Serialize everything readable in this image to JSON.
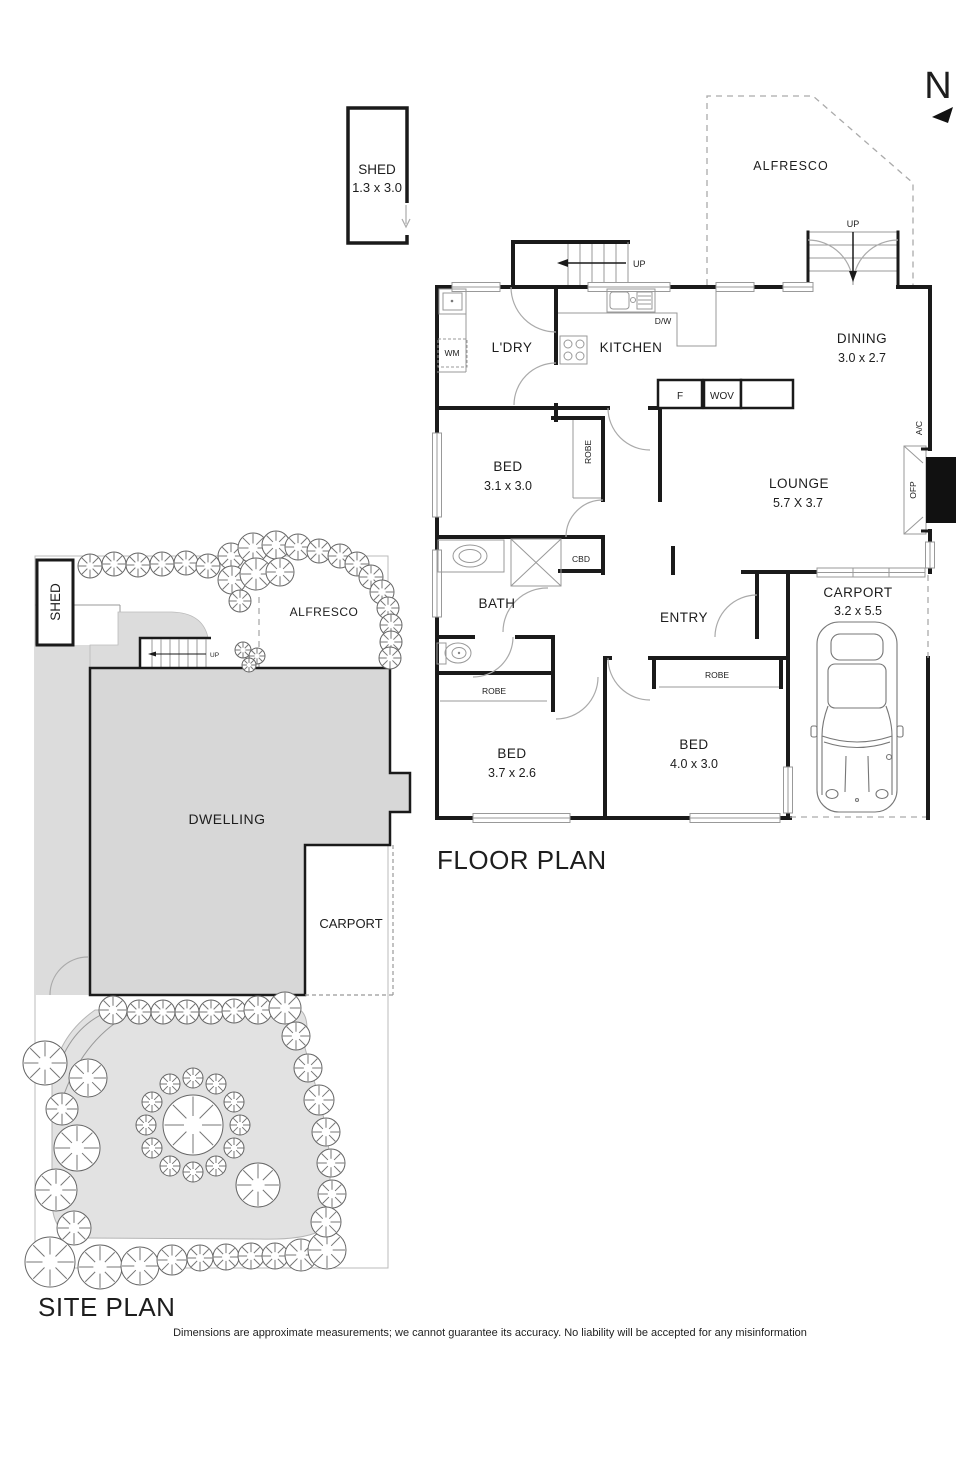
{
  "floor_plan": {
    "title": "FLOOR PLAN",
    "compass_letter": "N",
    "shed": {
      "name": "SHED",
      "dims": "1.3 x 3.0"
    },
    "alfresco_label": "ALFRESCO",
    "porch_up_label": "UP",
    "stairs_up_label": "UP",
    "rooms": {
      "laundry": "L'DRY",
      "kitchen": "KITCHEN",
      "dining": {
        "name": "DINING",
        "dims": "3.0 x 2.7"
      },
      "lounge": {
        "name": "LOUNGE",
        "dims": "5.7 X 3.7"
      },
      "bed1": {
        "name": "BED",
        "dims": "3.1 x 3.0"
      },
      "bed2": {
        "name": "BED",
        "dims": "3.7 x 2.6"
      },
      "bed3": {
        "name": "BED",
        "dims": "4.0 x 3.0"
      },
      "bath": "BATH",
      "entry": "ENTRY",
      "carport": {
        "name": "CARPORT",
        "dims": "3.2 x 5.5"
      }
    },
    "fixtures": {
      "washing_machine": "WM",
      "dishwasher": "D/W",
      "fridge": "F",
      "wall_oven": "WOV",
      "cupboard": "CBD",
      "robe": "ROBE",
      "air_conditioner": "A/C",
      "fireplace": "OFP"
    }
  },
  "site_plan": {
    "title": "SITE PLAN",
    "shed_label": "SHED",
    "alfresco_label": "ALFRESCO",
    "dwelling_label": "DWELLING",
    "carport_label": "CARPORT",
    "stairs_up_label": "UP"
  },
  "disclaimer": "Dimensions are approximate measurements; we cannot guarantee its accuracy. No liability will be accepted for any misinformation",
  "colors": {
    "wall": "#1a1a1a",
    "gray_fill": "#d7d7d7",
    "light_fill": "#e2e2e2"
  }
}
